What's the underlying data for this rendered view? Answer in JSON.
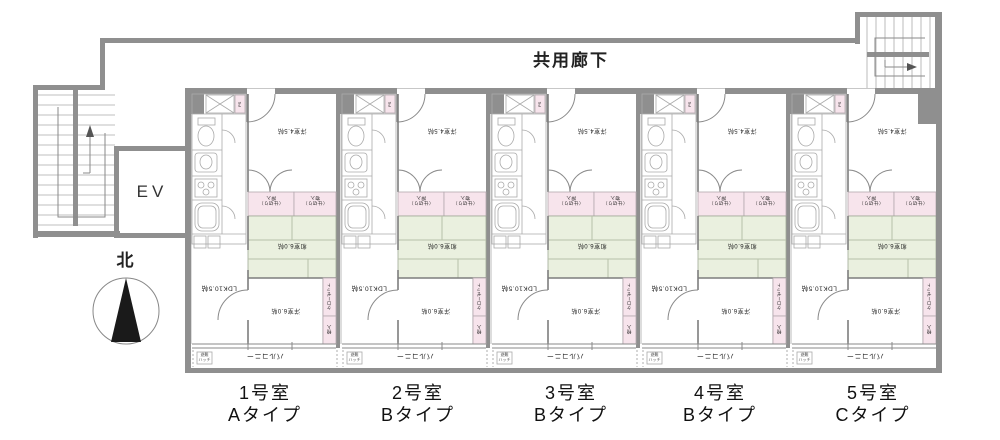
{
  "corridor_label": "共用廊下",
  "elevator_label": "EV",
  "compass_label": "北",
  "units": [
    {
      "number": "1号室",
      "type": "Aタイプ",
      "rooms": {
        "bedroom_top": "洋室4.5帖",
        "closet_left": "（仕切り）\n押入",
        "closet_right": "（仕切り）\n物入",
        "tatami": "和室6.0帖",
        "ldk": "LDK10.5帖",
        "bedroom_bottom": "洋室6.0帖",
        "closet_side": "クローゼット",
        "storage": "物入",
        "pipe_space": "PS",
        "balcony": "バルコニー",
        "hatch": "避難\nハッチ"
      }
    },
    {
      "number": "2号室",
      "type": "Bタイプ",
      "rooms": {
        "bedroom_top": "洋室4.5帖",
        "closet_left": "（仕切り）\n押入",
        "closet_right": "（仕切り）\n物入",
        "tatami": "和室6.0帖",
        "ldk": "LDK10.5帖",
        "bedroom_bottom": "洋室6.0帖",
        "closet_side": "クローゼット",
        "storage": "物入",
        "pipe_space": "PS",
        "balcony": "バルコニー",
        "hatch": "避難\nハッチ"
      }
    },
    {
      "number": "3号室",
      "type": "Bタイプ",
      "rooms": {
        "bedroom_top": "洋室4.5帖",
        "closet_left": "（仕切り）\n押入",
        "closet_right": "（仕切り）\n物入",
        "tatami": "和室6.0帖",
        "ldk": "LDK10.5帖",
        "bedroom_bottom": "洋室6.0帖",
        "closet_side": "クローゼット",
        "storage": "物入",
        "pipe_space": "PS",
        "balcony": "バルコニー",
        "hatch": "避難\nハッチ"
      }
    },
    {
      "number": "4号室",
      "type": "Bタイプ",
      "rooms": {
        "bedroom_top": "洋室4.5帖",
        "closet_left": "（仕切り）\n押入",
        "closet_right": "（仕切り）\n物入",
        "tatami": "和室6.0帖",
        "ldk": "LDK10.5帖",
        "bedroom_bottom": "洋室6.0帖",
        "closet_side": "クローゼット",
        "storage": "物入",
        "pipe_space": "PS",
        "balcony": "バルコニー",
        "hatch": "避難\nハッチ"
      }
    },
    {
      "number": "5号室",
      "type": "Cタイプ",
      "rooms": {
        "bedroom_top": "洋室4.5帖",
        "closet_left": "（仕切り）\n押入",
        "closet_right": "（仕切り）\n物入",
        "tatami": "和室6.0帖",
        "ldk": "LDK10.5帖",
        "bedroom_bottom": "洋室6.0帖",
        "closet_side": "クローゼット",
        "storage": "物入",
        "pipe_space": "PS",
        "balcony": "バルコニー",
        "hatch": "避難\nハッチ"
      }
    }
  ],
  "colors": {
    "wall": "#8f8f8f",
    "closet_pink": "#f7e4ec",
    "tatami_green": "#eaf0df",
    "compass_needle": "#1a1a1a"
  }
}
